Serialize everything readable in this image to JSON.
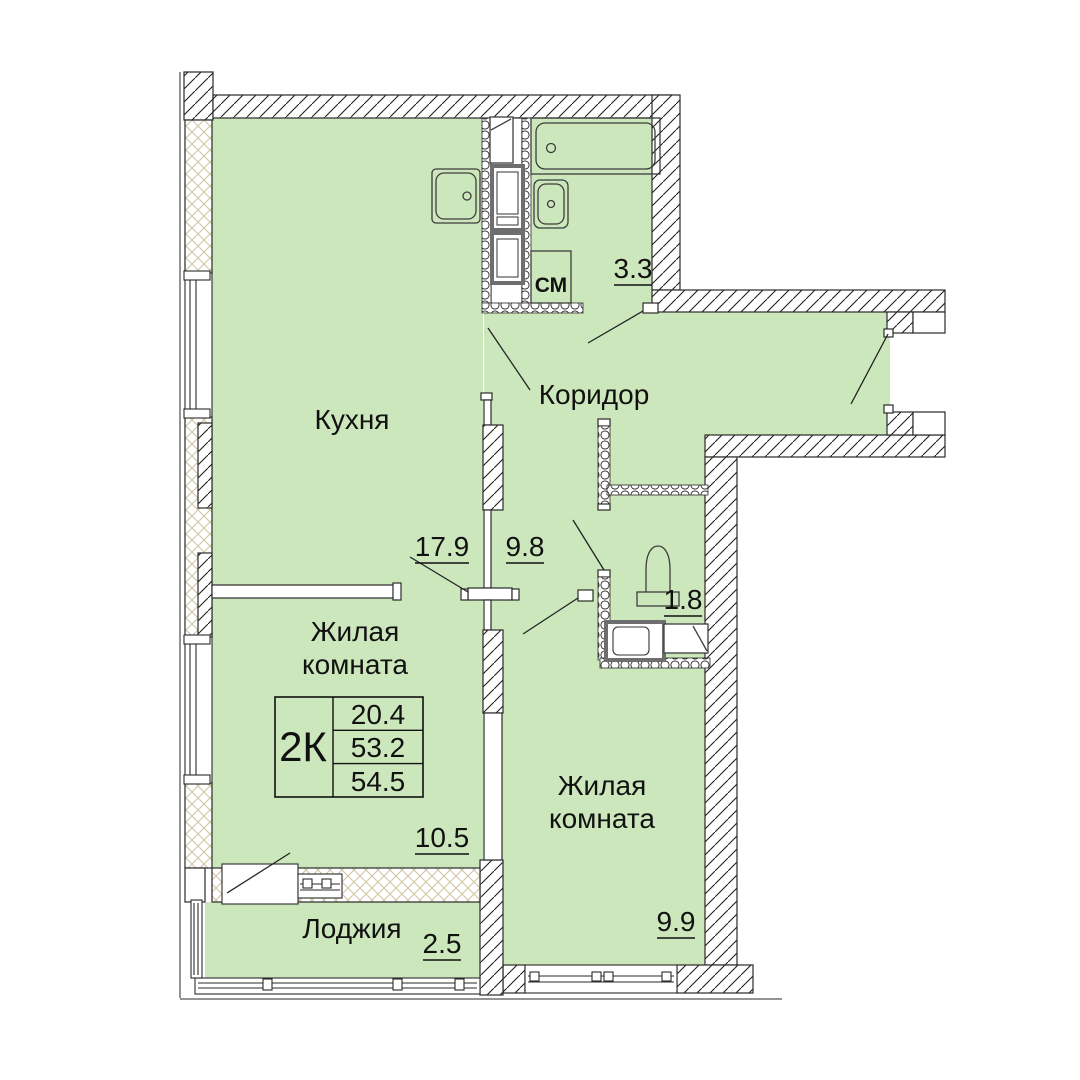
{
  "plan": {
    "unit_table": {
      "type": "2К",
      "living_area": "20.4",
      "area": "53.2",
      "total_area": "54.5"
    },
    "rooms": {
      "kitchen": {
        "label": "Кухня",
        "area": "17.9"
      },
      "corridor": {
        "label": "Коридор",
        "area": "9.8"
      },
      "bathroom": {
        "area": "3.3"
      },
      "wc": {
        "area": "1.8"
      },
      "living1": {
        "label_line1": "Жилая",
        "label_line2": "комната",
        "area": "10.5"
      },
      "living2": {
        "label_line1": "Жилая",
        "label_line2": "комната",
        "area": "9.9"
      },
      "loggia": {
        "label": "Лоджия",
        "area": "2.5"
      }
    },
    "appliances": {
      "washing_machine": "СМ"
    },
    "colors": {
      "room_fill": "#cde7bd",
      "wall_line": "#2a2a2a",
      "crosshatch": "#cfc49e"
    }
  }
}
